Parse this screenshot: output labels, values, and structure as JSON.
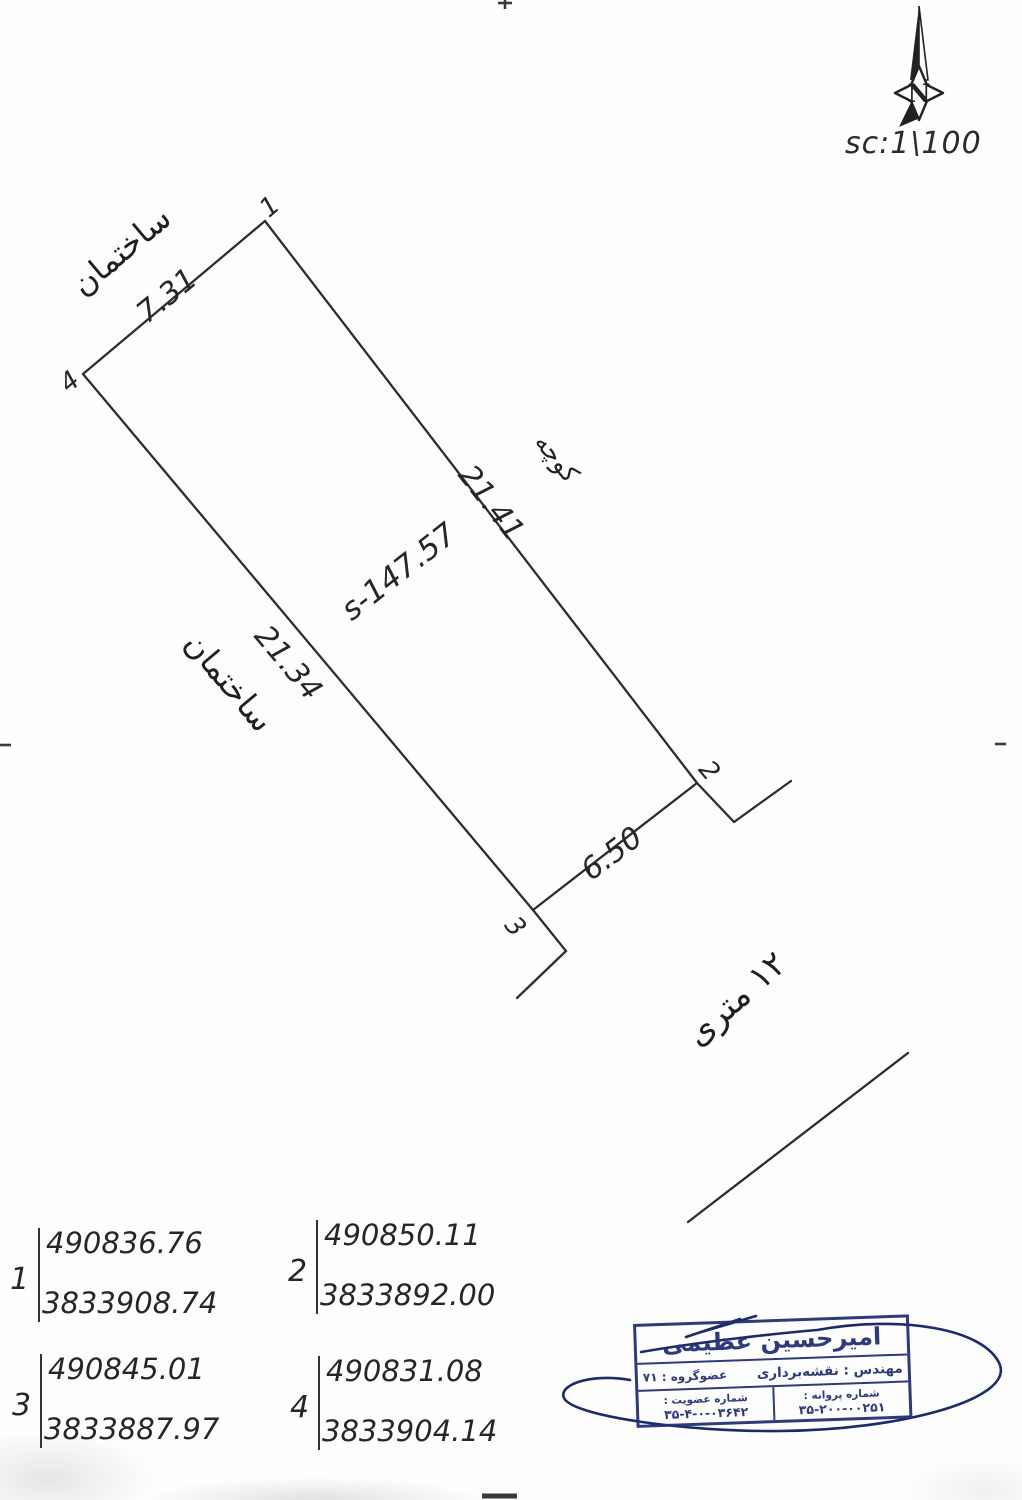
{
  "scale_label": "sc:1\\100",
  "north": {
    "letter": "N"
  },
  "parcel": {
    "area_label": "s-147.57",
    "dims": {
      "top": "7.31",
      "right": "21.41",
      "left": "21.34",
      "front": "6.50"
    },
    "adjacent": {
      "top": "ساختمان",
      "left": "ساختمان",
      "right": "کوچه"
    },
    "corner_marks": {
      "c1": "1",
      "c2": "2",
      "c3": "3",
      "c4": "4"
    }
  },
  "street": {
    "label": "۱۲ متری"
  },
  "points": [
    {
      "id": "1",
      "x": "490836.76",
      "y": "3833908.74"
    },
    {
      "id": "2",
      "x": "490850.11",
      "y": "3833892.00"
    },
    {
      "id": "3",
      "x": "490845.01",
      "y": "3833887.97"
    },
    {
      "id": "4",
      "x": "490831.08",
      "y": "3833904.14"
    }
  ],
  "stamp": {
    "name": "امیرحسین عظیمی",
    "profession": "مهندس : نقشه‌برداری",
    "group": "عضوگروه : ۷۱",
    "license_label": "شماره پروانه :",
    "license_number": "۳۵-۲۰۰-۰۰۲۵۱",
    "membership_label": "شماره عضویت :",
    "membership_number": "۳۵-۴-۰-۰۳۶۴۲"
  },
  "colors": {
    "ink": "#2d2d2d",
    "stamp_navy": "#22307a",
    "signature_navy": "#1b2a6e"
  }
}
